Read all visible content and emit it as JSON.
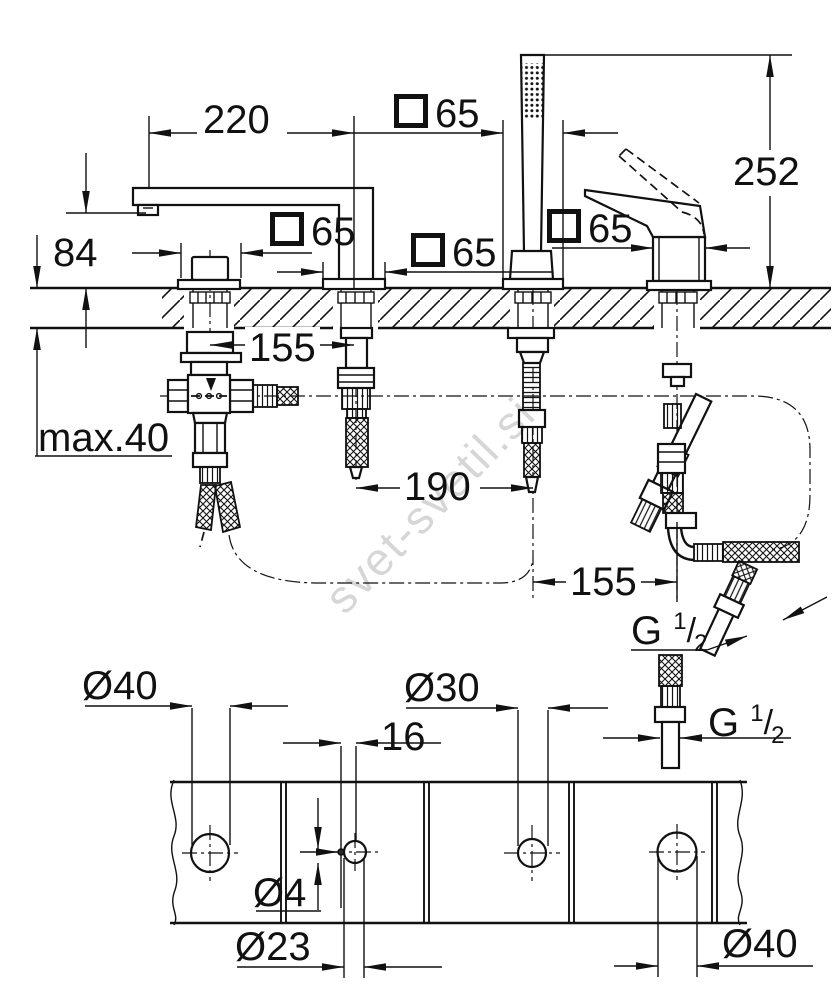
{
  "watermark": "svet-svetil.si",
  "top_view": {
    "spout_reach": "220",
    "overall_height": "252",
    "spout_height": "84",
    "deck_max_thickness": "max.40",
    "hole_spacing_1_2": "155",
    "hole_spacing_2_3": "190",
    "hole_spacing_3_4": "155",
    "escutcheon_top": "65",
    "escutcheon_hole1": "65",
    "escutcheon_hole2": "65",
    "escutcheon_hole4": "65",
    "thread_hose": {
      "prefix": "G",
      "numerator": "1",
      "slash": "/",
      "denominator": "2"
    },
    "thread_connector": {
      "prefix": "G",
      "numerator": "1",
      "slash": "/",
      "denominator": "2"
    }
  },
  "plan_view": {
    "hole1_diameter": "Ø40",
    "hole2_diameter": "Ø23",
    "pin_hole_diameter": "Ø4",
    "pin_hole_offset": "16",
    "hole3_diameter": "Ø30",
    "hole4_diameter": "Ø40"
  }
}
